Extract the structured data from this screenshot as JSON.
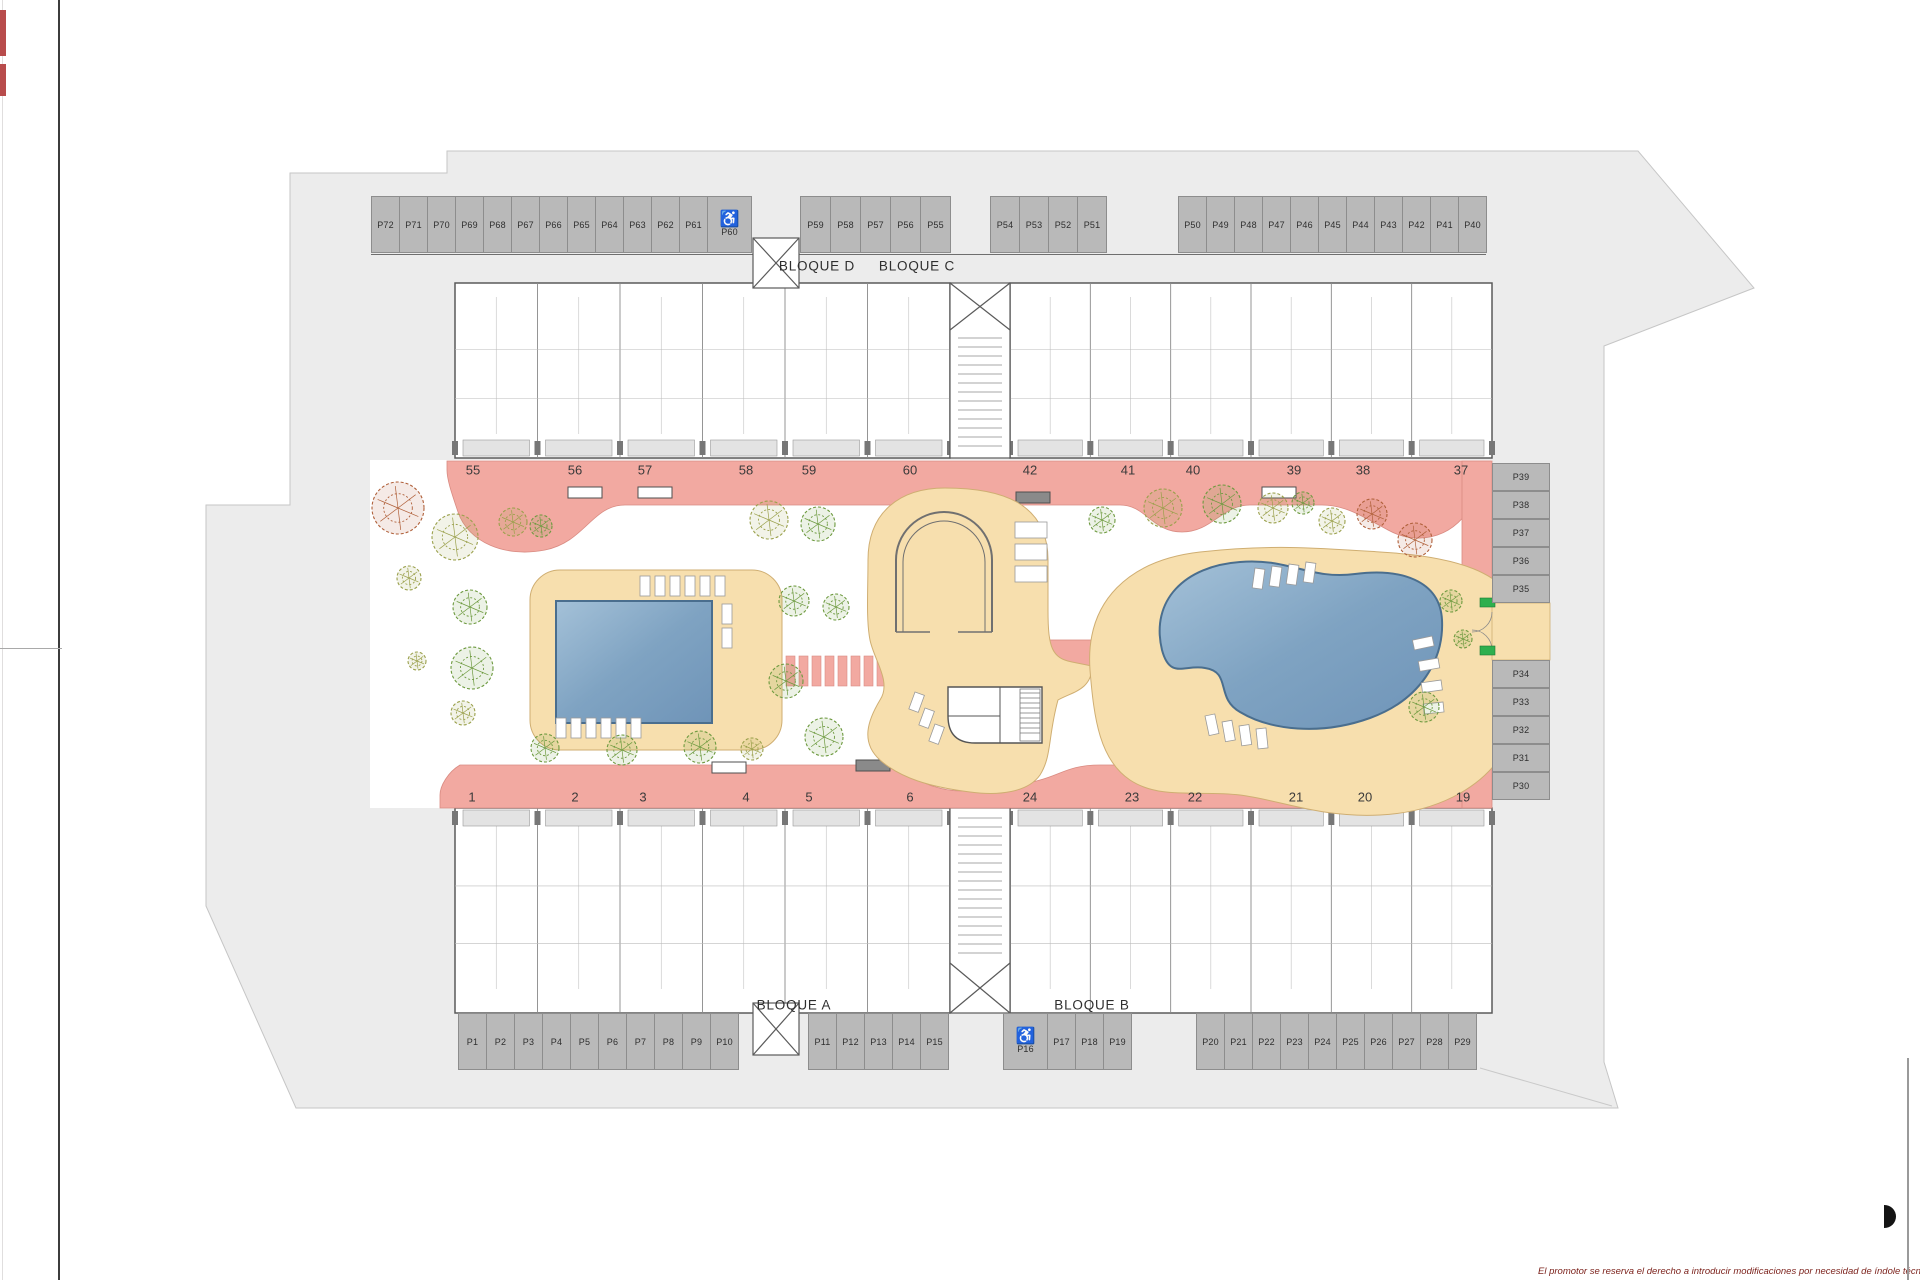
{
  "site": {
    "blocks": [
      {
        "id": "bloque-d",
        "label": "BLOQUE D"
      },
      {
        "id": "bloque-c",
        "label": "BLOQUE C"
      },
      {
        "id": "bloque-a",
        "label": "BLOQUE A"
      },
      {
        "id": "bloque-b",
        "label": "BLOQUE B"
      }
    ],
    "unit_numbers": {
      "top_row": [
        "55",
        "56",
        "57",
        "58",
        "59",
        "60",
        "42",
        "41",
        "40",
        "39",
        "38",
        "37"
      ],
      "bottom_row": [
        "1",
        "2",
        "3",
        "4",
        "5",
        "6",
        "24",
        "23",
        "22",
        "21",
        "20",
        "19"
      ]
    },
    "parking": {
      "accessible_icon": "♿",
      "top_row_groups": [
        {
          "labels": [
            "P72",
            "P71",
            "P70",
            "P69",
            "P68",
            "P67",
            "P66",
            "P65",
            "P64",
            "P63",
            "P62",
            "P61"
          ],
          "accessible": false
        },
        {
          "labels": [
            "P60"
          ],
          "accessible": true
        },
        {
          "labels": [
            "P59",
            "P58",
            "P57",
            "P56",
            "P55"
          ],
          "accessible": false
        },
        {
          "labels": [
            "P54",
            "P53",
            "P52",
            "P51"
          ],
          "accessible": false
        },
        {
          "labels": [
            "P50",
            "P49",
            "P48",
            "P47",
            "P46",
            "P45",
            "P44",
            "P43",
            "P42",
            "P41",
            "P40"
          ],
          "accessible": false
        }
      ],
      "bottom_row_groups": [
        {
          "labels": [
            "P1",
            "P2",
            "P3",
            "P4",
            "P5",
            "P6",
            "P7",
            "P8",
            "P9",
            "P10"
          ],
          "accessible": false
        },
        {
          "labels": [
            "P11",
            "P12",
            "P13",
            "P14",
            "P15"
          ],
          "accessible": false
        },
        {
          "labels": [
            "P16"
          ],
          "accessible": true
        },
        {
          "labels": [
            "P17",
            "P18",
            "P19"
          ],
          "accessible": false
        },
        {
          "labels": [
            "P20",
            "P21",
            "P22",
            "P23",
            "P24",
            "P25",
            "P26",
            "P27",
            "P28",
            "P29"
          ],
          "accessible": false
        }
      ],
      "right_column_groups": [
        {
          "labels": [
            "P39",
            "P38",
            "P37",
            "P36",
            "P35"
          ],
          "accessible": false
        },
        {
          "labels": [
            "P34",
            "P33",
            "P32",
            "P31",
            "P30"
          ],
          "accessible": false
        }
      ]
    },
    "disclaimer": "El promotor se reserva el derecho a introducir modificaciones por necesidad de índole técnica o legal",
    "colors": {
      "walkway_pink": "#f2a9a1",
      "walkway_pink_edge": "#d98b82",
      "deck_beige": "#f7dfae",
      "deck_edge": "#cfae72",
      "pool_blue_light": "#9dbcd4",
      "pool_blue_dark": "#6f94b8",
      "pool_edge": "#4a6e8e",
      "site_grey": "#ececec",
      "site_edge": "#c6c6c6",
      "stall_grey": "#b9b9b9",
      "wall_grey": "#5a5a5a",
      "tree_green": "#6d9a3f",
      "tree_olive": "#9aa04b",
      "tree_red": "#b0603a",
      "sign_green": "#2eaf4e",
      "disclaimer_red": "#7d241e"
    }
  }
}
